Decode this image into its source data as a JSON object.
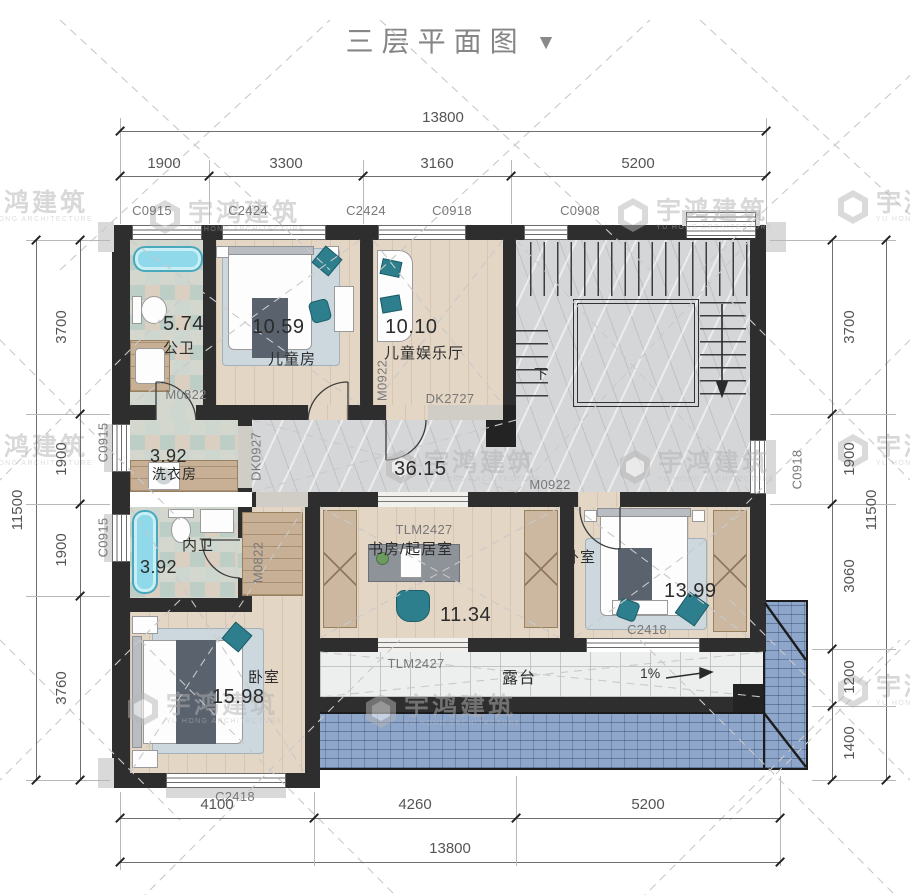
{
  "title": {
    "text": "三层平面图",
    "collapse_icon": "▼"
  },
  "watermark": {
    "cn": "宇鸿建筑",
    "en": "YU HONG ARCHITECTURE"
  },
  "dimensions": {
    "top": {
      "total": "13800",
      "segments": [
        "1900",
        "3300",
        "3160",
        "5200"
      ]
    },
    "bottom": {
      "total": "13800",
      "segments": [
        "4100",
        "4260",
        "5200"
      ]
    },
    "left": {
      "total": "11500",
      "segments": [
        "3700",
        "1900",
        "1900",
        "3760"
      ]
    },
    "right": {
      "total": "11500",
      "segments": [
        "3700",
        "1900",
        "3060",
        "1200",
        "1400"
      ]
    }
  },
  "rooms": {
    "public_bath": {
      "name": "公卫",
      "area": "5.74"
    },
    "kids_bedroom": {
      "name": "儿童房",
      "area": "10.59"
    },
    "kids_lounge": {
      "name": "儿童娱乐厅",
      "area": "10.10"
    },
    "laundry": {
      "name": "洗衣房",
      "area": "3.92"
    },
    "ensuite_bath": {
      "name": "内卫",
      "area": "3.92"
    },
    "study": {
      "name": "书房/起居室",
      "area": "11.34"
    },
    "bedroom_right": {
      "name": "卧室",
      "area": "13.99"
    },
    "bedroom_left": {
      "name": "卧室",
      "area": "15.98"
    },
    "hall": {
      "area": "36.15"
    },
    "terrace": {
      "name": "露台"
    }
  },
  "openings": {
    "top_windows": [
      "C0915",
      "C2424",
      "C2424",
      "C0918",
      "C0908"
    ],
    "left_windows": [
      "C0915",
      "C0915"
    ],
    "right_window": "C0918",
    "bottom_window_left": "C2418",
    "terrace_window_right": "C2418",
    "doors": {
      "bath_door": "M0822",
      "lounge_door": "M0922",
      "lounge_opening": "DK2727",
      "laundry_opening": "DK0927",
      "bedroom_right_door": "M0922",
      "ensuite_door": "M0822",
      "study_terrace_door": "TLM2427",
      "terrace_door": "TLM2427"
    }
  },
  "annotations": {
    "stair_down": "下",
    "slope": "1%"
  }
}
